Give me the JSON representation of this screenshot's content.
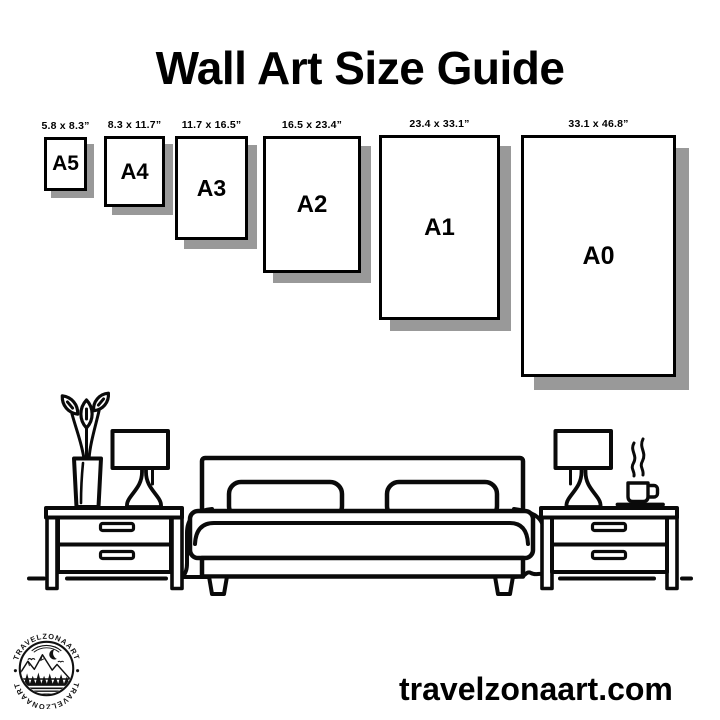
{
  "page": {
    "title": "Wall Art Size Guide",
    "website": "travelzonaart.com",
    "background_color": "#ffffff",
    "ink_color": "#000000",
    "shadow_color": "#999999"
  },
  "size_guide": {
    "sizes": [
      {
        "code": "A5",
        "dimensions": "5.8 x 8.3”"
      },
      {
        "code": "A4",
        "dimensions": "8.3 x 11.7”"
      },
      {
        "code": "A3",
        "dimensions": "11.7 x 16.5”"
      },
      {
        "code": "A2",
        "dimensions": "16.5 x 23.4”"
      },
      {
        "code": "A1",
        "dimensions": "23.4 x 33.1”"
      },
      {
        "code": "A0",
        "dimensions": "33.1 x 46.8”"
      }
    ]
  },
  "logo": {
    "brand_top": "TRAVELZONAART",
    "brand_bottom": "TRAVELZONAART"
  },
  "illustration": {
    "items": [
      "flower-vase",
      "table-lamp",
      "bed-with-pillows",
      "nightstand",
      "coffee-cup",
      "floor-line"
    ]
  }
}
